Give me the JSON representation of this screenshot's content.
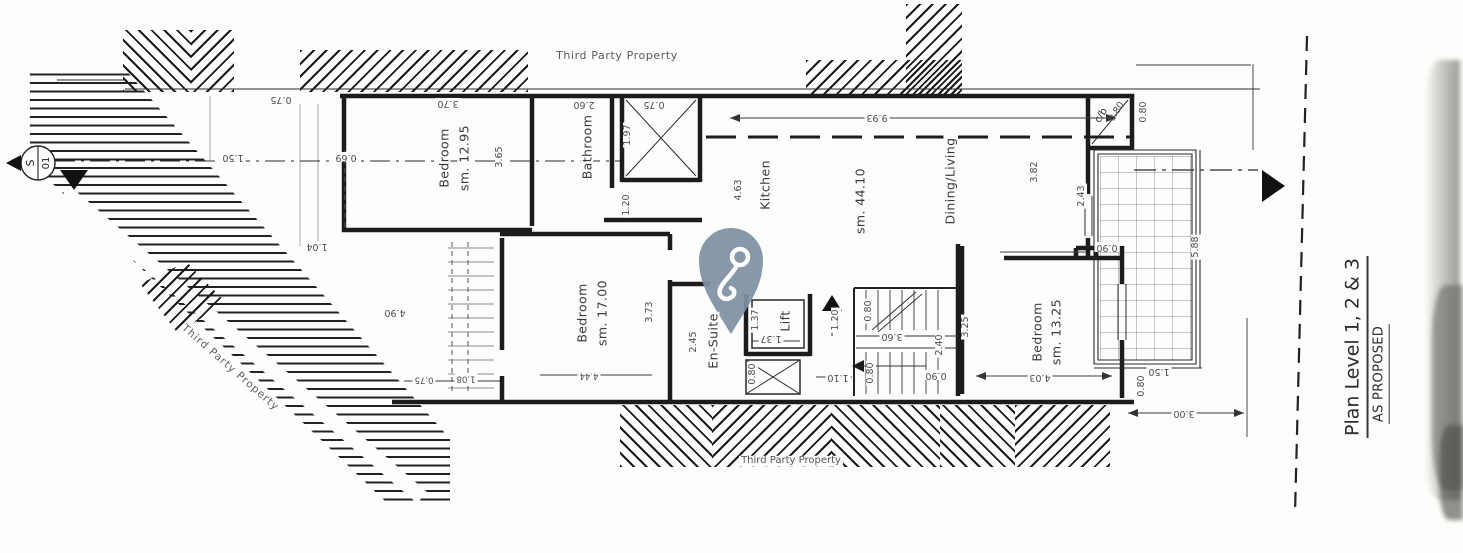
{
  "title_block": {
    "plan_title": "Plan Level 1, 2 & 3",
    "plan_status": "AS PROPOSED"
  },
  "annotations": {
    "third_party_top": "Third Party Property",
    "third_party_left": "Third Party Property",
    "third_party_bottom": "Third Party Property"
  },
  "section_marker": {
    "letter": "S",
    "number": "01"
  },
  "marker": {
    "name": "location-pin",
    "color": "#7d90a4"
  },
  "rooms": {
    "bedroom1": {
      "name": "Bedroom",
      "area": "sm. 12.95"
    },
    "bathroom": {
      "name": "Bathroom"
    },
    "kitchen": {
      "name": "Kitchen"
    },
    "living": {
      "name": "Dining/Living",
      "area": "sm. 44.10"
    },
    "bedroom2": {
      "name": "Bedroom",
      "area": "sm. 17.00"
    },
    "ensuite": {
      "name": "En-Suite"
    },
    "lift": {
      "name": "Lift"
    },
    "bedroom3": {
      "name": "Bedroom",
      "area": "sm. 13.25"
    },
    "cb": {
      "name": "c/b"
    }
  },
  "dims": {
    "top_left_offset": "0.75",
    "bedroom1_width": "3.70",
    "bedroom1_depth": "3.65",
    "bedroom1_bottom": "1.04",
    "section_left": "1.50",
    "wall_left": "0.69",
    "bathroom_width": "2.60",
    "shaft_width": "0.75",
    "shaft_height": "1.97",
    "bath_passage": "1.20",
    "kitchen_depth": "4.63",
    "living_length": "9.93",
    "living_depth": "3.82",
    "terrace_top": "2.43",
    "cb_size": "0.80",
    "cb_right": "0.80",
    "terrace_len": "5.88",
    "terrace_inner": "0.90",
    "stair_void": "4.90",
    "bottom_left_a": "0.75",
    "bottom_left_b": "1.08",
    "bedroom2_width": "4.44",
    "bedroom2_depth": "3.73",
    "ensuite_width": "2.45",
    "lift_w": "1.37",
    "lift_h": "1.37",
    "lift_shaft": "0.80",
    "lobby": "1.10",
    "entrance": "1.20",
    "stairs_top": "0.80",
    "stairs_mid": "3.60",
    "stairs_bottom": "0.80",
    "stairs_width": "2.40",
    "stairs_exit": "0.90",
    "hall": "3.25",
    "bedroom3_width": "4.03",
    "terrace_end_a": "0.80",
    "terrace_end_b": "1.50",
    "bottom_right": "3.00"
  }
}
